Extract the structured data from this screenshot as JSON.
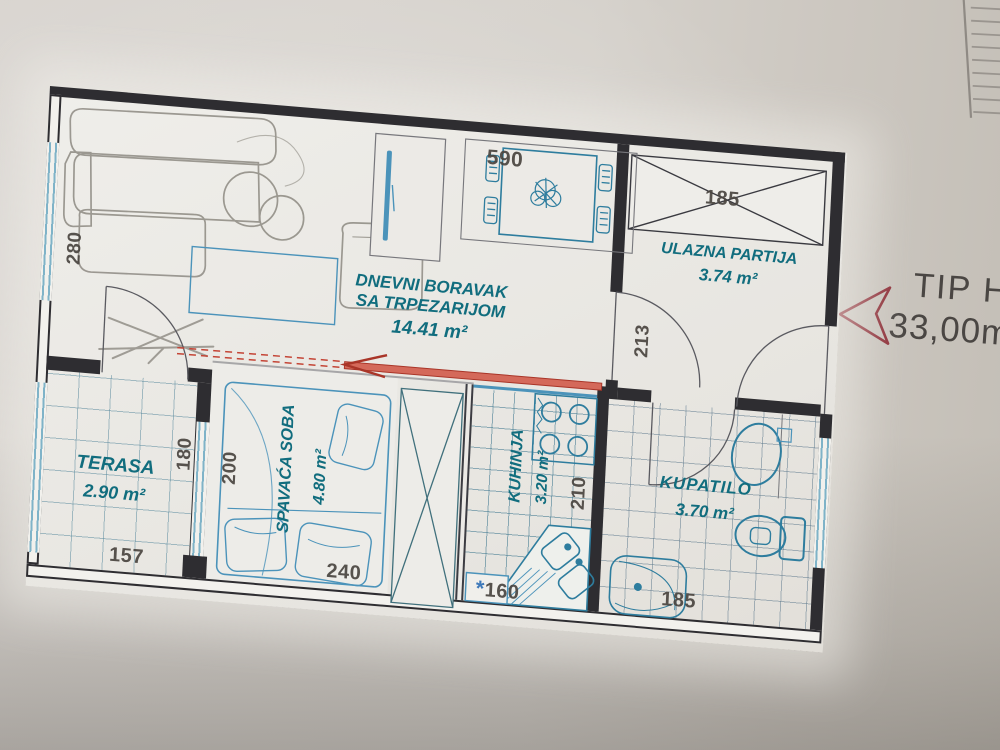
{
  "plan": {
    "type_label": "TIP H",
    "total_area_label": "33,00m2",
    "rooms": [
      {
        "name": "DNEVNI BORAVAK",
        "name_line2": "SA TRPEZARIJOM",
        "area": "14.41 m²"
      },
      {
        "name": "ULAZNA PARTIJA",
        "area": "3.74 m²"
      },
      {
        "name": "TERASA",
        "area": "2.90 m²"
      },
      {
        "name": "SPAVAĆA SOBA",
        "area": "4.80 m²"
      },
      {
        "name": "KUHINJA",
        "area": "3.20 m²"
      },
      {
        "name": "KUPATILO",
        "area": "3.70 m²"
      }
    ],
    "dimensions_cm": {
      "living_top": "590",
      "living_left": "280",
      "entrance_closet": "185",
      "entrance_depth": "213",
      "terrace_right": "180",
      "terrace_bottom": "157",
      "bedroom_left": "200",
      "bedroom_bottom": "240",
      "kitchen_bottom": "160",
      "kitchen_right": "210",
      "bathroom_bottom": "185",
      "kitchen_bottom_note": "*"
    },
    "colors": {
      "label_teal": "#116d7e",
      "furniture_blue": "#2e7d9e",
      "annotation_red": "#b03a2e",
      "wall_ink": "#2e2d31",
      "dimension_ink": "#4a4540",
      "type_arrow_red": "#8e3039"
    }
  }
}
